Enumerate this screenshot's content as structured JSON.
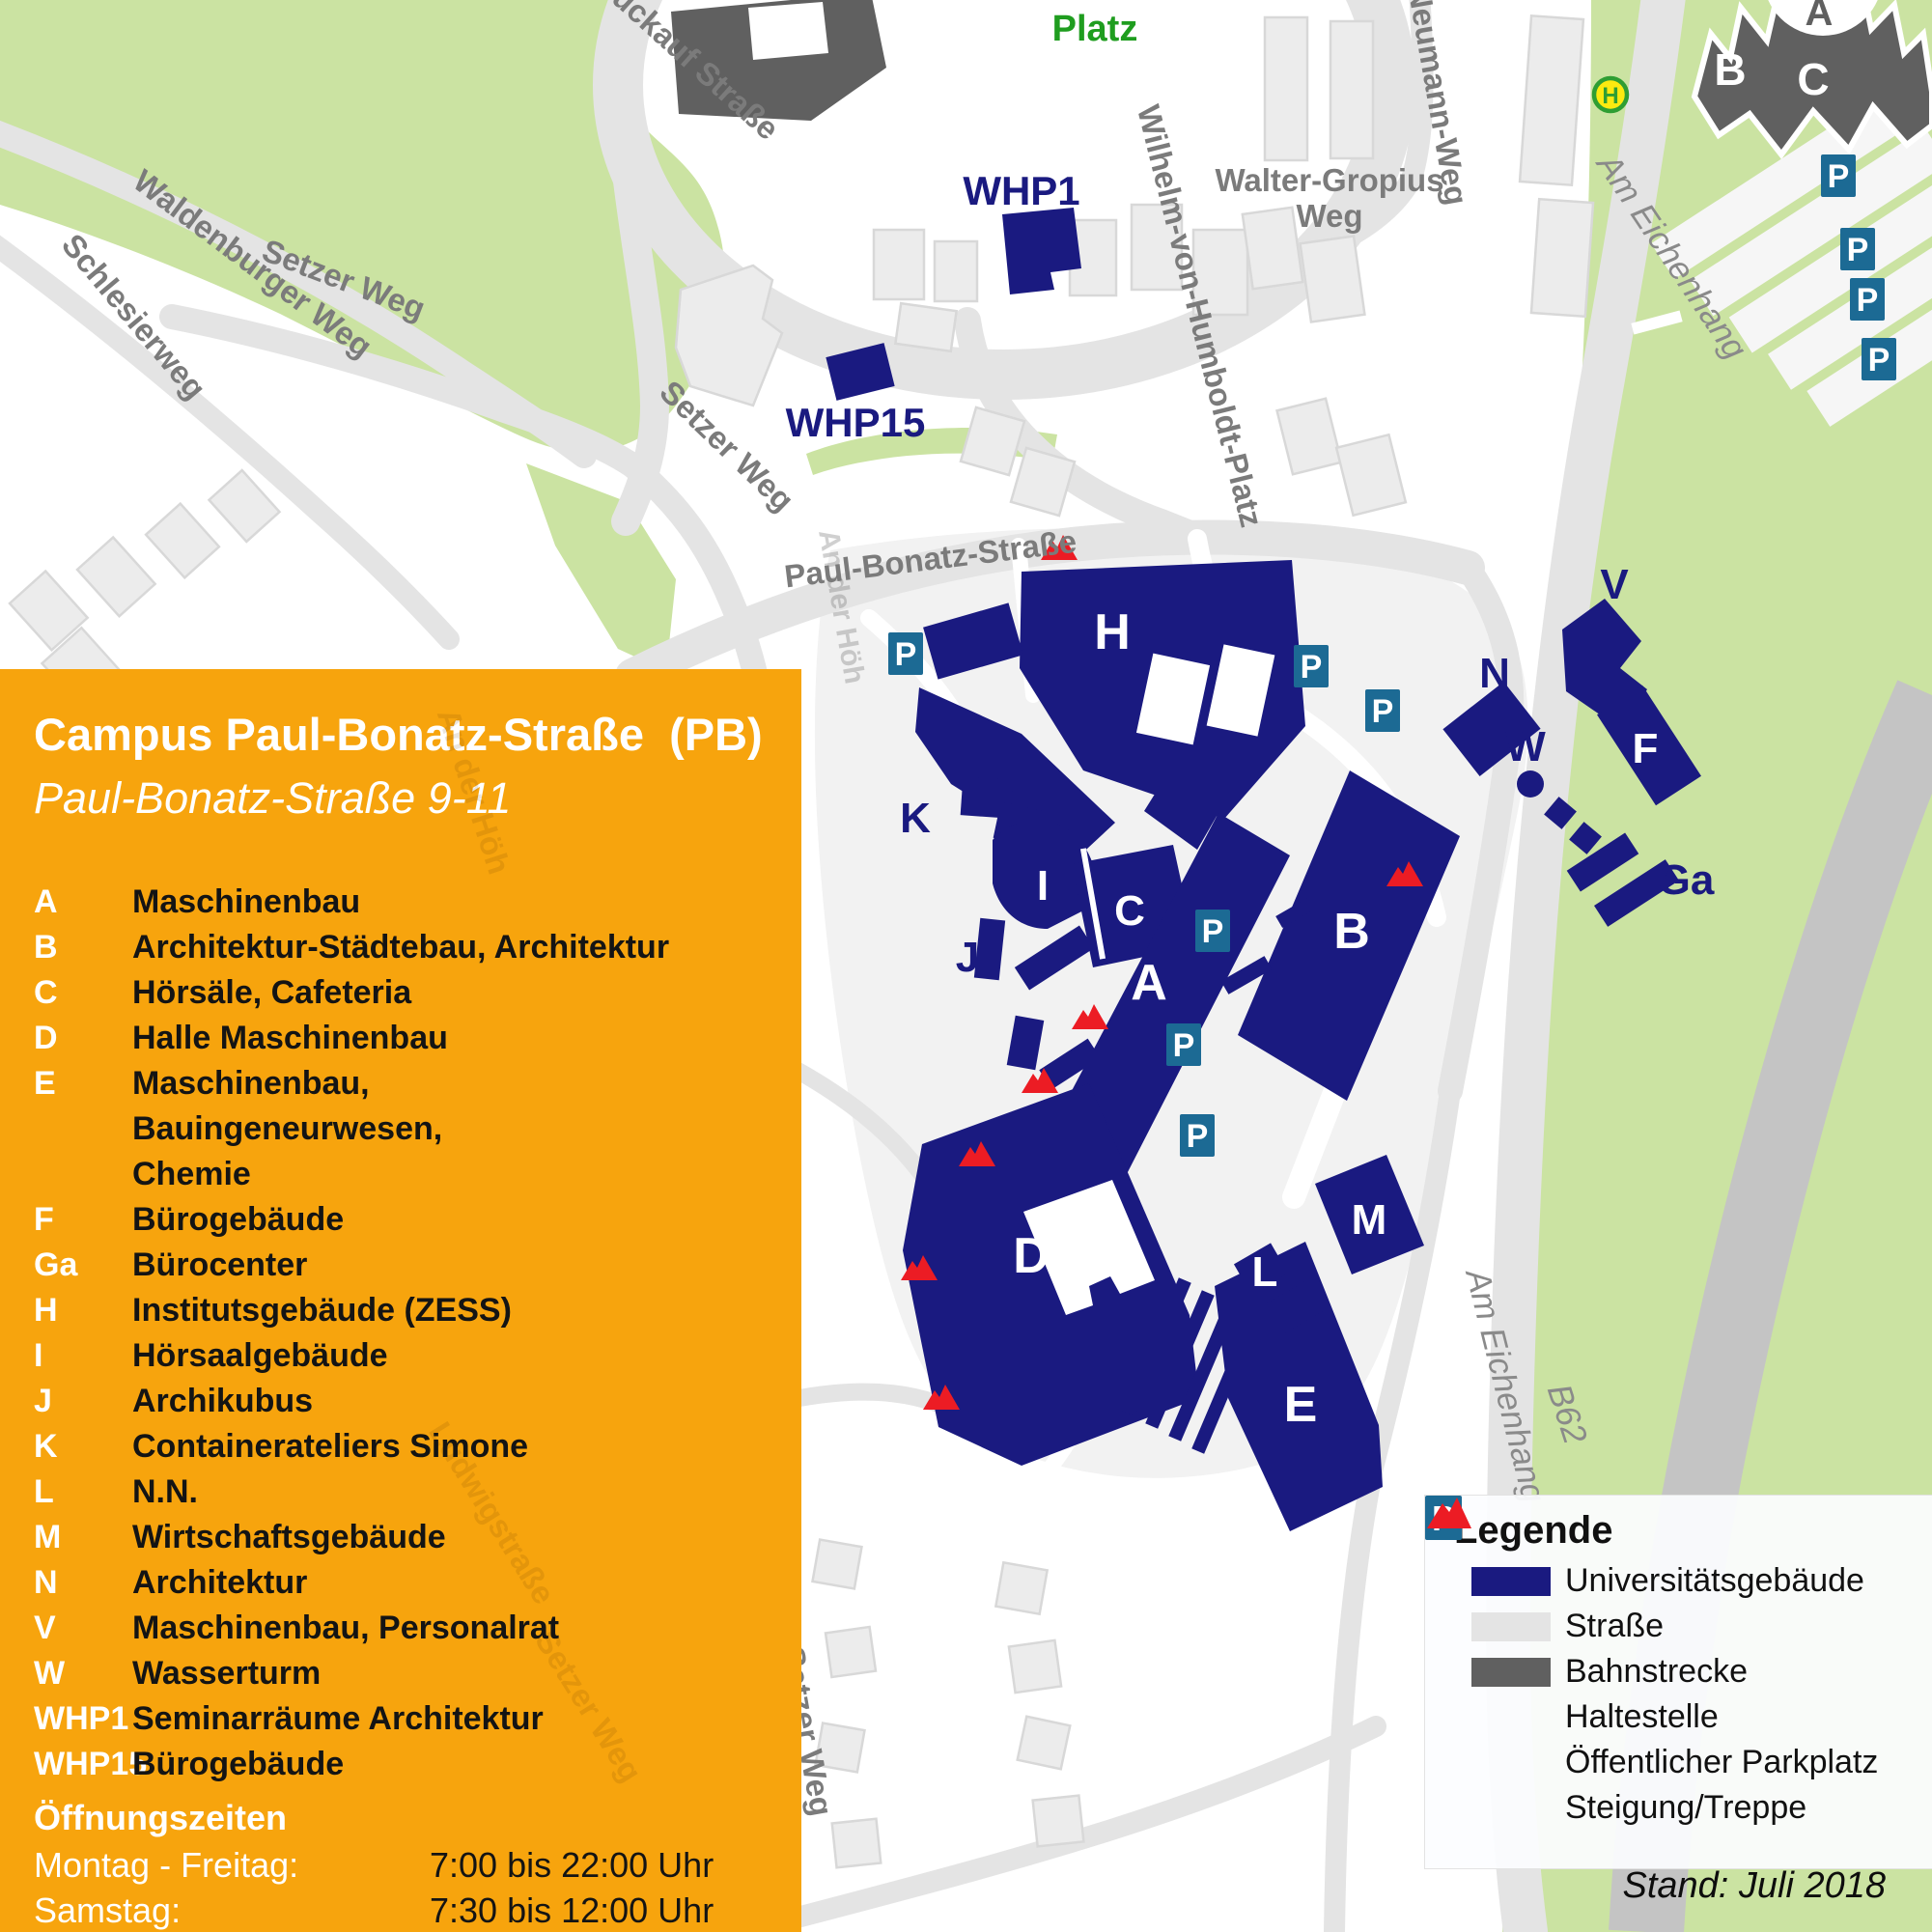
{
  "panel": {
    "title": "Campus Paul-Bonatz-Straße  (PB)",
    "subtitle": "Paul-Bonatz-Straße 9-11",
    "buildings": [
      {
        "code": "A",
        "name": "Maschinenbau"
      },
      {
        "code": "B",
        "name": "Architektur-Städtebau, Architektur"
      },
      {
        "code": "C",
        "name": "Hörsäle, Cafeteria"
      },
      {
        "code": "D",
        "name": "Halle Maschinenbau"
      },
      {
        "code": "E",
        "name": "Maschinenbau, Bauingeneurwesen,\nChemie"
      },
      {
        "code": "F",
        "name": "Bürogebäude"
      },
      {
        "code": "Ga",
        "name": "Bürocenter"
      },
      {
        "code": "H",
        "name": "Institutsgebäude (ZESS)"
      },
      {
        "code": "I",
        "name": "Hörsaalgebäude"
      },
      {
        "code": "J",
        "name": "Archikubus"
      },
      {
        "code": "K",
        "name": "Containerateliers Simone"
      },
      {
        "code": "L",
        "name": "N.N."
      },
      {
        "code": "M",
        "name": "Wirtschaftsgebäude"
      },
      {
        "code": "N",
        "name": "Architektur"
      },
      {
        "code": "V",
        "name": "Maschinenbau, Personalrat"
      },
      {
        "code": "W",
        "name": "Wasserturm"
      },
      {
        "code": "WHP1",
        "name": "Seminarräume Architektur"
      },
      {
        "code": "WHP15",
        "name": "Bürogebäude"
      }
    ],
    "hours": {
      "heading": "Öffnungszeiten",
      "rows": [
        {
          "label": "Montag - Freitag:",
          "value": "7:00 bis 22:00 Uhr"
        },
        {
          "label": "Samstag:",
          "value": "7:30 bis 12:00 Uhr"
        }
      ]
    },
    "watermarks": [
      {
        "text": "Ludwigstraße"
      },
      {
        "text": "Setzer Weg"
      },
      {
        "text": "An der Höh"
      }
    ]
  },
  "map": {
    "street_labels": [
      {
        "text": "Waldenburger Weg"
      },
      {
        "text": "Schlesierweg"
      },
      {
        "text": "Setzer Weg"
      },
      {
        "text": "Setzer Weg"
      },
      {
        "text": "Setzer Weg"
      },
      {
        "text": "Setzer Weg"
      },
      {
        "text": "Glückauf Straße"
      },
      {
        "text": "Paul-Bonatz-Straße"
      },
      {
        "text": "Wilhelm-von-Humboldt-Platz"
      },
      {
        "text": "Walter-Gropius"
      },
      {
        "text": "Weg"
      },
      {
        "text": "-Neumann-Weg"
      },
      {
        "text": "Am Eichenhang"
      },
      {
        "text": "Am Eichenhang"
      },
      {
        "text": "B62"
      }
    ],
    "area_labels": [
      {
        "text": "Platz"
      }
    ],
    "building_letters": [
      {
        "text": "H"
      },
      {
        "text": "C"
      },
      {
        "text": "I"
      },
      {
        "text": "A"
      },
      {
        "text": "B"
      },
      {
        "text": "D"
      },
      {
        "text": "E"
      },
      {
        "text": "M"
      },
      {
        "text": "L"
      },
      {
        "text": "F"
      }
    ],
    "campus_labels": [
      {
        "text": "K"
      },
      {
        "text": "J"
      },
      {
        "text": "N"
      },
      {
        "text": "V"
      },
      {
        "text": "W"
      },
      {
        "text": "Ga"
      },
      {
        "text": "WHP1"
      },
      {
        "text": "WHP15"
      }
    ],
    "castle": {
      "a": "A",
      "b": "B",
      "c": "C"
    },
    "stop_label": "H",
    "parking_label": "P"
  },
  "legend": {
    "title": "Legende",
    "items": [
      {
        "icon": "university-building",
        "label": "Universitätsgebäude"
      },
      {
        "icon": "street",
        "label": "Straße"
      },
      {
        "icon": "railway",
        "label": "Bahnstrecke"
      },
      {
        "icon": "bus-stop",
        "label": "Haltestelle"
      },
      {
        "icon": "public-parking",
        "label": "Öffentlicher Parkplatz"
      },
      {
        "icon": "stairs-slope",
        "label": "Steigung/Treppe"
      }
    ],
    "stand": "Stand: Juli 2018"
  },
  "colors": {
    "panel_orange": "#F7A40D",
    "university_navy": "#1A1A80",
    "parking_teal": "#1C6A94",
    "stairs_red": "#EC1C24",
    "park_green": "#CBE3A2",
    "platz_green": "#1F9D1F",
    "street_gray": "#E4E4E4",
    "railway_gray": "#606060",
    "stop_yellow": "#FCEA10",
    "stop_green": "#2F9E33"
  }
}
